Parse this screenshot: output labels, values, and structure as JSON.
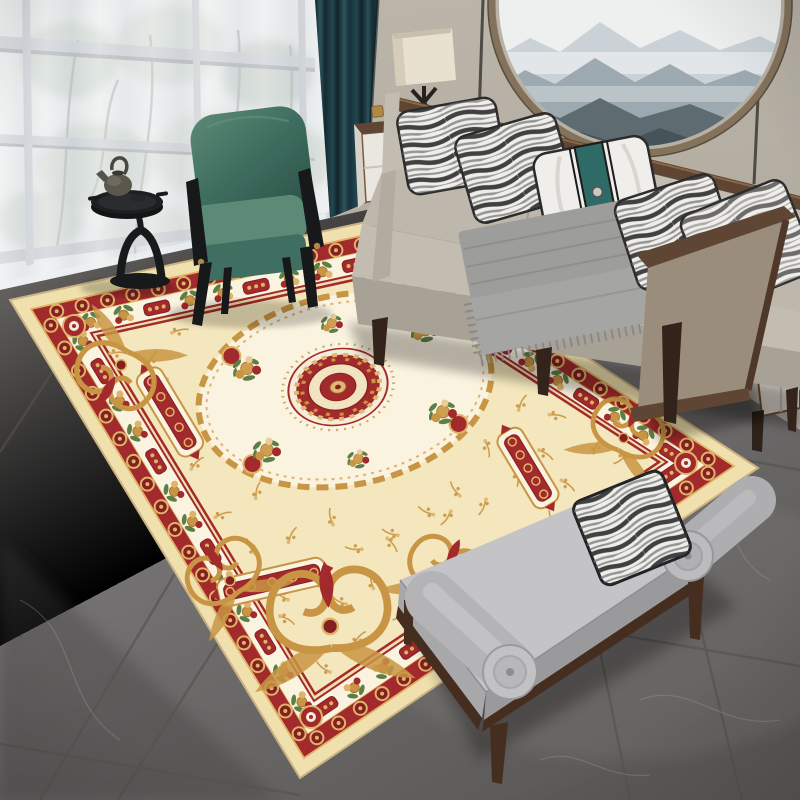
{
  "scene": {
    "type": "photograph",
    "setting": "modern living room with a classic cream, red and gold medallion area rug on gray marble tile",
    "objects": [
      "sheer-curtained window with trees outside",
      "dark teal drape",
      "round misty-mountain wall art",
      "beige paneled wall",
      "gray fabric sofa with walnut wood trim",
      "ink-wash patterned throw pillows",
      "white pillow with teal band",
      "gray throw blanket",
      "green velvet armchair with black frame",
      "black pedestal side table with teapot",
      "cream box floor lamp",
      "white side cabinet with wood top",
      "oriental medallion rug",
      "gray marble tile floor",
      "gray upholstered bench with bolster cushions",
      "teal vase on sideboard"
    ]
  },
  "palette": {
    "wall": "#b8b2a7",
    "wall_dark": "#a8a296",
    "wall_seam": "#35322d",
    "wood_trim": "#5e4534",
    "wood_light": "#7d5f46",
    "wood_dark": "#33231a",
    "art_frame": "#83725c",
    "art_sky": "#eef0f0",
    "art_far": "#c4ccd2",
    "art_mid": "#9aa6ae",
    "art_dark": "#5e6c72",
    "art_darkest": "#46545a",
    "window_backdrop": "#dfe3e0",
    "mullion": "#a2a8ad",
    "mullion_dark": "#60666c",
    "foliage": "#a3b1a0",
    "foliage_light": "#b7c2b2",
    "branch": "#6b6b63",
    "curtain_teal": "#1c3940",
    "curtain_teal_dark": "#0f2428",
    "curtain_teal_light": "#2d545e",
    "floor": "#757371",
    "floor_dark": "#4e4c4a",
    "floor_light": "#8c8a88",
    "grout": "#55524f",
    "vein": "#a8a6a3",
    "rug_cream": "#efe0ad",
    "rug_field": "#f4e7bd",
    "rug_red": "#a32a2c",
    "rug_red_dark": "#841f22",
    "rug_gold": "#c89544",
    "rug_gold_light": "#dfb469",
    "rug_gold_pale": "#e8cd96",
    "rug_ivory": "#faf3e0",
    "rug_green": "#5d7f45",
    "sofa_fabric": "#c3bcb0",
    "sofa_seat": "#beb7ab",
    "sofa_base": "#a8a195",
    "sofa_arm_tan": "#9a8d7b",
    "pillow_white": "#efeeea",
    "pillow_ink": "#2f2f2f",
    "pillow_teal": "#2f6b66",
    "throw_gray": "#9d9d9b",
    "throw_gray_dark": "#8b8b89",
    "chair_green": "#3f6f60",
    "chair_green_light": "#5d8a77",
    "chair_green_dark": "#2e564a",
    "chair_frame": "#17181a",
    "table_black": "#1c1e20",
    "bench_gray": "#b5b5b7",
    "bench_gray_light": "#c4c4c6",
    "bench_gray_dark": "#9a9a9c",
    "bench_wood": "#452e20",
    "lamp_shade": "#e9e1d0",
    "lamp_shade_dark": "#d6cdb9",
    "cabinet_white": "#eae7e0",
    "cabinet_side": "#d6d2c9",
    "brass": "#b08848",
    "vase_teal": "#2f6b62"
  }
}
